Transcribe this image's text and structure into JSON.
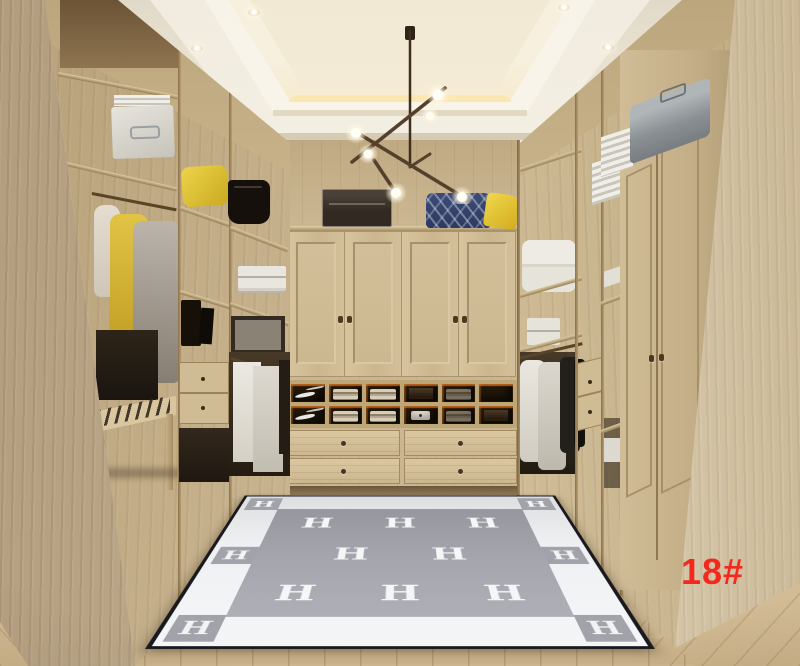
{
  "watermark": {
    "text": "18#",
    "color": "#f5281e"
  },
  "rug": {
    "letter": "H",
    "field_rows": [
      [
        "H",
        "H",
        "H"
      ],
      [
        "H",
        "H"
      ],
      [
        "H",
        "H",
        "H"
      ]
    ],
    "border_squares": [
      "H",
      "H",
      "H",
      "H",
      "H",
      "H"
    ],
    "colors": {
      "field": "#a3a3ab",
      "border": "#f1f2f4",
      "trim": "#1a1a1e",
      "letter": "#f5f6f8"
    }
  },
  "palette": {
    "wood_light": "#d5c29e",
    "wood_mid": "#c3ae87",
    "wood_dark": "#8d7653",
    "ceiling": "#f4efe5",
    "cove_glow": "#f4dfab",
    "floor": "#c8b28c",
    "accent_yellow": "#e5c93c",
    "accent_navy": "#35426b",
    "cubby_led": "#c96a22",
    "watermark_red": "#f5281e"
  },
  "scene": {
    "label": "walk-in closet"
  }
}
